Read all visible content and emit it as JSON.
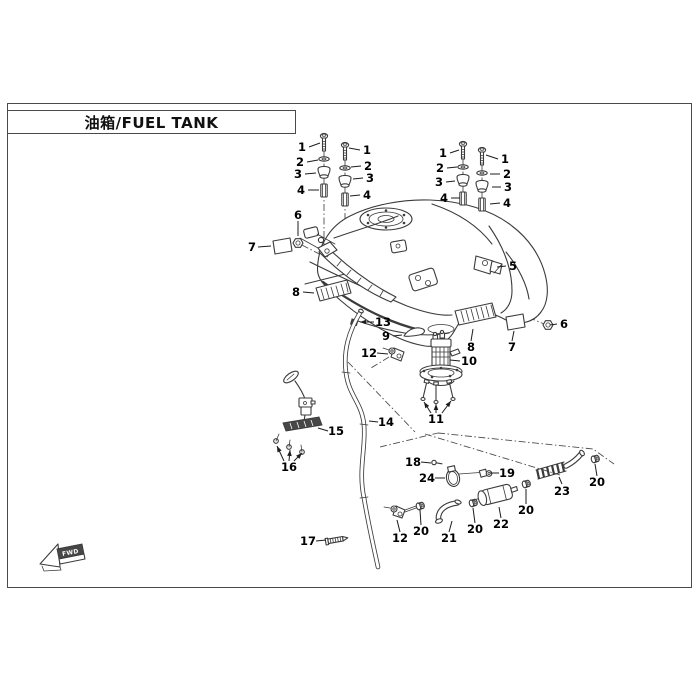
{
  "title": {
    "text": "油箱/FUEL TANK"
  },
  "direction_indicator": {
    "label": "FWD"
  },
  "colors": {
    "line": "#3b3b3b",
    "label": "#000000",
    "frame_border": "#4a4a4a",
    "bg": "#ffffff",
    "dark_fill": "#474747"
  },
  "callouts": [
    {
      "label": "1",
      "x": 302,
      "y": 147,
      "leaders": [
        [
          309,
          147,
          320,
          143
        ]
      ]
    },
    {
      "label": "1",
      "x": 367,
      "y": 150,
      "leaders": [
        [
          360,
          150,
          349,
          148
        ]
      ]
    },
    {
      "label": "2",
      "x": 300,
      "y": 162,
      "leaders": [
        [
          307,
          162,
          318,
          160
        ]
      ]
    },
    {
      "label": "2",
      "x": 368,
      "y": 166,
      "leaders": [
        [
          361,
          166,
          351,
          167
        ]
      ]
    },
    {
      "label": "3",
      "x": 298,
      "y": 174,
      "leaders": [
        [
          305,
          174,
          316,
          173
        ]
      ]
    },
    {
      "label": "3",
      "x": 370,
      "y": 178,
      "leaders": [
        [
          363,
          178,
          353,
          179
        ]
      ]
    },
    {
      "label": "4",
      "x": 301,
      "y": 190,
      "leaders": [
        [
          308,
          190,
          319,
          190
        ]
      ]
    },
    {
      "label": "4",
      "x": 367,
      "y": 195,
      "leaders": [
        [
          360,
          195,
          350,
          196
        ]
      ]
    },
    {
      "label": "6",
      "x": 298,
      "y": 215,
      "leaders": [
        [
          298,
          221,
          298,
          236
        ]
      ]
    },
    {
      "label": "7",
      "x": 252,
      "y": 247,
      "leaders": [
        [
          258,
          247,
          271,
          246
        ]
      ]
    },
    {
      "label": "1",
      "x": 443,
      "y": 153,
      "leaders": [
        [
          450,
          153,
          459,
          150
        ]
      ]
    },
    {
      "label": "1",
      "x": 505,
      "y": 159,
      "leaders": [
        [
          498,
          159,
          486,
          155
        ]
      ]
    },
    {
      "label": "2",
      "x": 440,
      "y": 168,
      "leaders": [
        [
          447,
          168,
          457,
          167
        ]
      ]
    },
    {
      "label": "2",
      "x": 507,
      "y": 174,
      "leaders": [
        [
          500,
          174,
          490,
          174
        ]
      ]
    },
    {
      "label": "3",
      "x": 439,
      "y": 182,
      "leaders": [
        [
          446,
          182,
          455,
          181
        ]
      ]
    },
    {
      "label": "3",
      "x": 508,
      "y": 187,
      "leaders": [
        [
          501,
          187,
          492,
          187
        ]
      ]
    },
    {
      "label": "4",
      "x": 444,
      "y": 198,
      "leaders": [
        [
          451,
          198,
          460,
          198
        ]
      ]
    },
    {
      "label": "4",
      "x": 507,
      "y": 203,
      "leaders": [
        [
          500,
          203,
          490,
          204
        ]
      ]
    },
    {
      "label": "5",
      "x": 513,
      "y": 266,
      "leaders": [
        [
          506,
          266,
          497,
          267
        ]
      ]
    },
    {
      "label": "6",
      "x": 564,
      "y": 324,
      "leaders": [
        [
          557,
          324,
          550,
          325
        ]
      ]
    },
    {
      "label": "7",
      "x": 512,
      "y": 347,
      "leaders": [
        [
          512,
          341,
          514,
          331
        ]
      ]
    },
    {
      "label": "8",
      "x": 471,
      "y": 347,
      "leaders": [
        [
          471,
          341,
          473,
          329
        ]
      ]
    },
    {
      "label": "8",
      "x": 296,
      "y": 292,
      "leaders": [
        [
          303,
          292,
          314,
          293
        ]
      ]
    },
    {
      "label": "13",
      "x": 383,
      "y": 322,
      "leaders": [
        [
          374,
          322,
          360,
          322,
          1
        ]
      ]
    },
    {
      "label": "9",
      "x": 386,
      "y": 336,
      "leaders": [
        [
          393,
          336,
          402,
          335
        ]
      ]
    },
    {
      "label": "12",
      "x": 369,
      "y": 353,
      "leaders": [
        [
          377,
          353,
          388,
          354
        ]
      ]
    },
    {
      "label": "10",
      "x": 469,
      "y": 361,
      "leaders": [
        [
          460,
          361,
          450,
          360
        ]
      ]
    },
    {
      "label": "11",
      "x": 436,
      "y": 419,
      "leaders": [
        [
          431,
          413,
          424,
          402,
          1
        ],
        [
          436,
          413,
          436,
          404,
          1
        ],
        [
          442,
          413,
          451,
          401,
          1
        ]
      ]
    },
    {
      "label": "14",
      "x": 386,
      "y": 422,
      "leaders": [
        [
          378,
          422,
          369,
          421
        ]
      ]
    },
    {
      "label": "15",
      "x": 336,
      "y": 431,
      "leaders": [
        [
          328,
          431,
          318,
          428
        ]
      ]
    },
    {
      "label": "16",
      "x": 289,
      "y": 467,
      "leaders": [
        [
          284,
          461,
          277,
          446,
          1
        ],
        [
          289,
          461,
          290,
          450,
          1
        ],
        [
          294,
          461,
          302,
          453,
          1
        ]
      ]
    },
    {
      "label": "17",
      "x": 308,
      "y": 541,
      "leaders": [
        [
          316,
          541,
          326,
          540
        ]
      ]
    },
    {
      "label": "18",
      "x": 413,
      "y": 462,
      "leaders": [
        [
          421,
          462,
          431,
          463
        ]
      ]
    },
    {
      "label": "24",
      "x": 427,
      "y": 478,
      "leaders": [
        [
          435,
          478,
          445,
          478
        ]
      ]
    },
    {
      "label": "19",
      "x": 507,
      "y": 473,
      "leaders": [
        [
          499,
          473,
          490,
          473
        ]
      ]
    },
    {
      "label": "23",
      "x": 562,
      "y": 491,
      "leaders": [
        [
          562,
          484,
          559,
          477
        ]
      ]
    },
    {
      "label": "20",
      "x": 597,
      "y": 482,
      "leaders": [
        [
          597,
          476,
          595,
          464
        ]
      ]
    },
    {
      "label": "20",
      "x": 526,
      "y": 510,
      "leaders": [
        [
          526,
          504,
          526,
          489
        ]
      ]
    },
    {
      "label": "22",
      "x": 501,
      "y": 524,
      "leaders": [
        [
          501,
          518,
          499,
          507
        ]
      ]
    },
    {
      "label": "20",
      "x": 475,
      "y": 529,
      "leaders": [
        [
          475,
          523,
          473,
          508
        ]
      ]
    },
    {
      "label": "21",
      "x": 449,
      "y": 538,
      "leaders": [
        [
          449,
          532,
          452,
          521
        ]
      ]
    },
    {
      "label": "20",
      "x": 421,
      "y": 531,
      "leaders": [
        [
          421,
          525,
          420,
          510
        ]
      ]
    },
    {
      "label": "12",
      "x": 400,
      "y": 538,
      "leaders": [
        [
          400,
          532,
          397,
          520
        ]
      ]
    }
  ]
}
